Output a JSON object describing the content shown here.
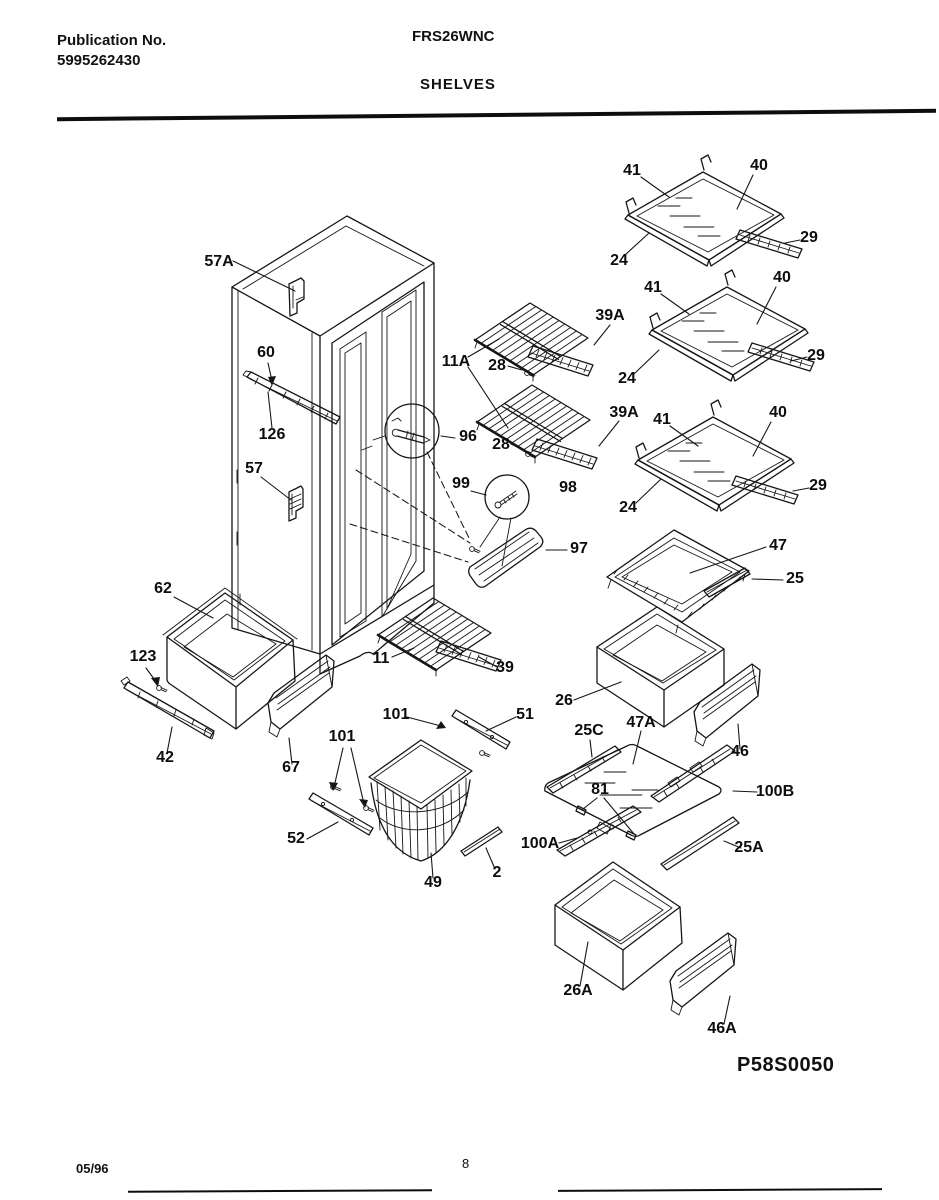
{
  "header": {
    "publication_label": "Publication No.",
    "publication_number": "5995262430",
    "model": "FRS26WNC",
    "section_title": "SHELVES"
  },
  "footer": {
    "date_code": "05/96",
    "page_number": "8"
  },
  "diagram": {
    "code": "P58S0050",
    "callouts": [
      {
        "t": "57A",
        "x": 219,
        "y": 266
      },
      {
        "t": "60",
        "x": 266,
        "y": 357
      },
      {
        "t": "126",
        "x": 272,
        "y": 439
      },
      {
        "t": "57",
        "x": 254,
        "y": 473
      },
      {
        "t": "11A",
        "x": 456,
        "y": 366
      },
      {
        "t": "28",
        "x": 497,
        "y": 370
      },
      {
        "t": "28",
        "x": 501,
        "y": 449
      },
      {
        "t": "39A",
        "x": 610,
        "y": 320
      },
      {
        "t": "39A",
        "x": 624,
        "y": 417
      },
      {
        "t": "96",
        "x": 468,
        "y": 441
      },
      {
        "t": "99",
        "x": 461,
        "y": 488
      },
      {
        "t": "98",
        "x": 568,
        "y": 492
      },
      {
        "t": "97",
        "x": 579,
        "y": 553
      },
      {
        "t": "41",
        "x": 632,
        "y": 175
      },
      {
        "t": "40",
        "x": 759,
        "y": 170
      },
      {
        "t": "24",
        "x": 619,
        "y": 265
      },
      {
        "t": "29",
        "x": 809,
        "y": 242
      },
      {
        "t": "41",
        "x": 653,
        "y": 292
      },
      {
        "t": "40",
        "x": 782,
        "y": 282
      },
      {
        "t": "24",
        "x": 627,
        "y": 383
      },
      {
        "t": "29",
        "x": 816,
        "y": 360
      },
      {
        "t": "41",
        "x": 662,
        "y": 424
      },
      {
        "t": "40",
        "x": 778,
        "y": 417
      },
      {
        "t": "24",
        "x": 628,
        "y": 512
      },
      {
        "t": "29",
        "x": 818,
        "y": 490
      },
      {
        "t": "47",
        "x": 778,
        "y": 550
      },
      {
        "t": "25",
        "x": 795,
        "y": 583
      },
      {
        "t": "62",
        "x": 163,
        "y": 593
      },
      {
        "t": "123",
        "x": 143,
        "y": 661
      },
      {
        "t": "42",
        "x": 165,
        "y": 762
      },
      {
        "t": "67",
        "x": 291,
        "y": 772
      },
      {
        "t": "101",
        "x": 342,
        "y": 741
      },
      {
        "t": "52",
        "x": 296,
        "y": 843
      },
      {
        "t": "11",
        "x": 381,
        "y": 663
      },
      {
        "t": "39",
        "x": 505,
        "y": 672
      },
      {
        "t": "101",
        "x": 396,
        "y": 719
      },
      {
        "t": "51",
        "x": 525,
        "y": 719
      },
      {
        "t": "49",
        "x": 433,
        "y": 887
      },
      {
        "t": "2",
        "x": 497,
        "y": 877
      },
      {
        "t": "26",
        "x": 564,
        "y": 705
      },
      {
        "t": "25C",
        "x": 589,
        "y": 735
      },
      {
        "t": "47A",
        "x": 641,
        "y": 727
      },
      {
        "t": "81",
        "x": 600,
        "y": 794
      },
      {
        "t": "100A",
        "x": 540,
        "y": 848
      },
      {
        "t": "100B",
        "x": 775,
        "y": 796
      },
      {
        "t": "25A",
        "x": 749,
        "y": 852
      },
      {
        "t": "46",
        "x": 740,
        "y": 756
      },
      {
        "t": "26A",
        "x": 578,
        "y": 995
      },
      {
        "t": "46A",
        "x": 722,
        "y": 1033
      }
    ]
  }
}
